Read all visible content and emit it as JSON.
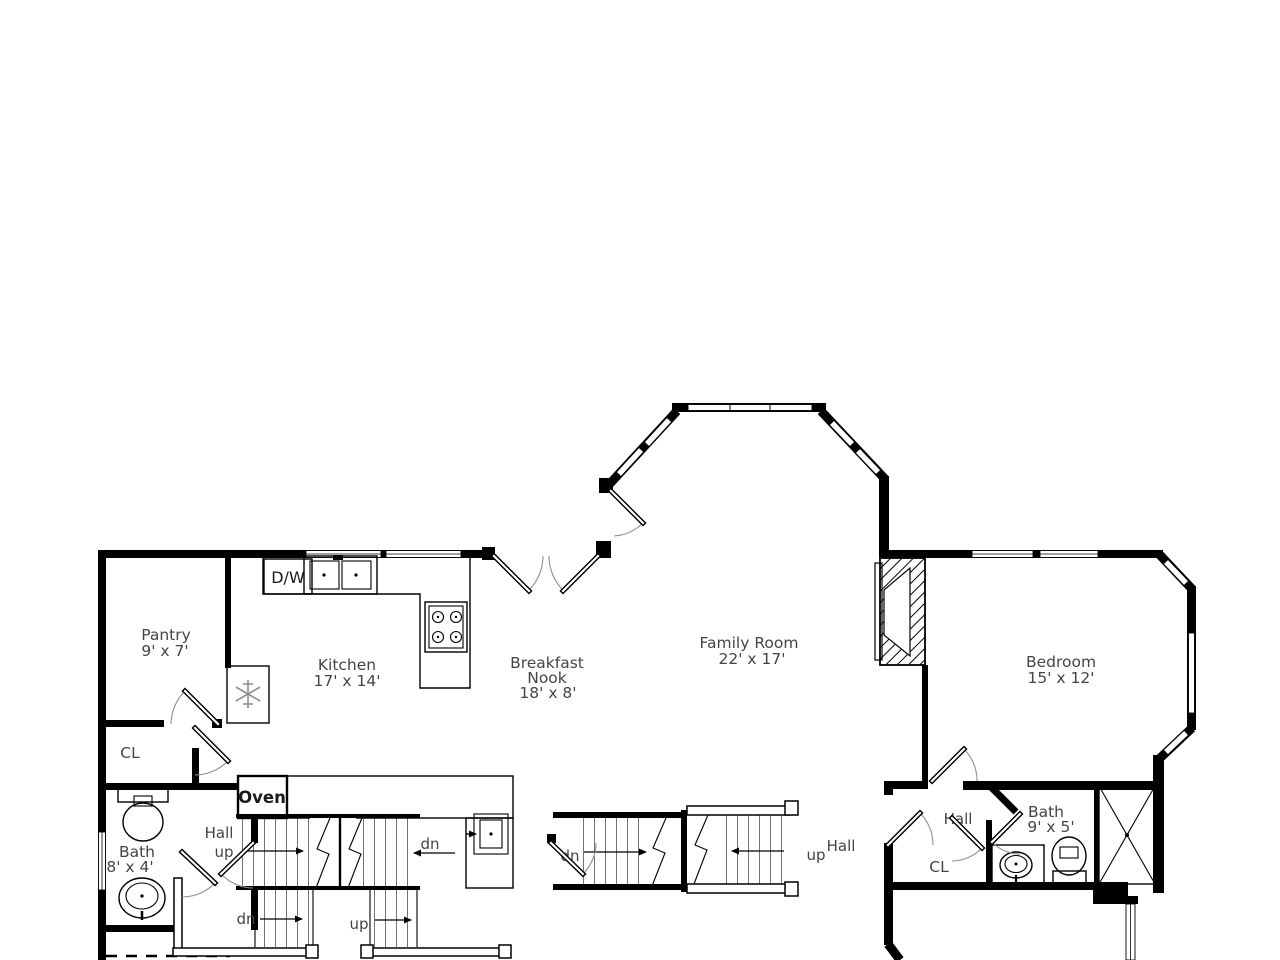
{
  "title": "First floor plan",
  "colors": {
    "wall": "#000000",
    "label": "#454545",
    "door_arc": "#8f8f8f",
    "background": "#ffffff"
  },
  "rooms": {
    "pantry": {
      "name": "Pantry",
      "dims": "9' x 7'"
    },
    "kitchen": {
      "name": "Kitchen",
      "dims": "17' x 14'"
    },
    "nook": {
      "line1": "Breakfast",
      "line2": "Nook",
      "dims": "18' x 8'"
    },
    "family": {
      "name": "Family Room",
      "dims": "22' x 17'"
    },
    "bedroom": {
      "name": "Bedroom",
      "dims": "15' x 12'"
    },
    "bath_small": {
      "name": "Bath",
      "dims": "8' x 4'"
    },
    "bath_hall": {
      "name": "Bath",
      "dims": "9' x 5'"
    }
  },
  "closets": {
    "left": "CL",
    "right": "CL"
  },
  "halls": {
    "left": "Hall",
    "middle": "Hall",
    "right": "Hall"
  },
  "appliances": {
    "dishwasher": "D/W",
    "oven": "Oven"
  },
  "stairs": {
    "upper_up": "up",
    "upper_dn": "dn",
    "lower_dn": "dn",
    "lower_up": "up",
    "mid_dn": "dn",
    "mid_up": "up"
  },
  "icons": {
    "refrigerator": "snowflake-icon",
    "stove": "four-burner-stove-icon",
    "kitchen_sink": "double-basin-sink-icon",
    "fireplace": "hatched-fireplace-icon",
    "shower": "x-box-shower-icon",
    "toilet": "toilet-icon",
    "basin": "oval-basin-icon"
  }
}
